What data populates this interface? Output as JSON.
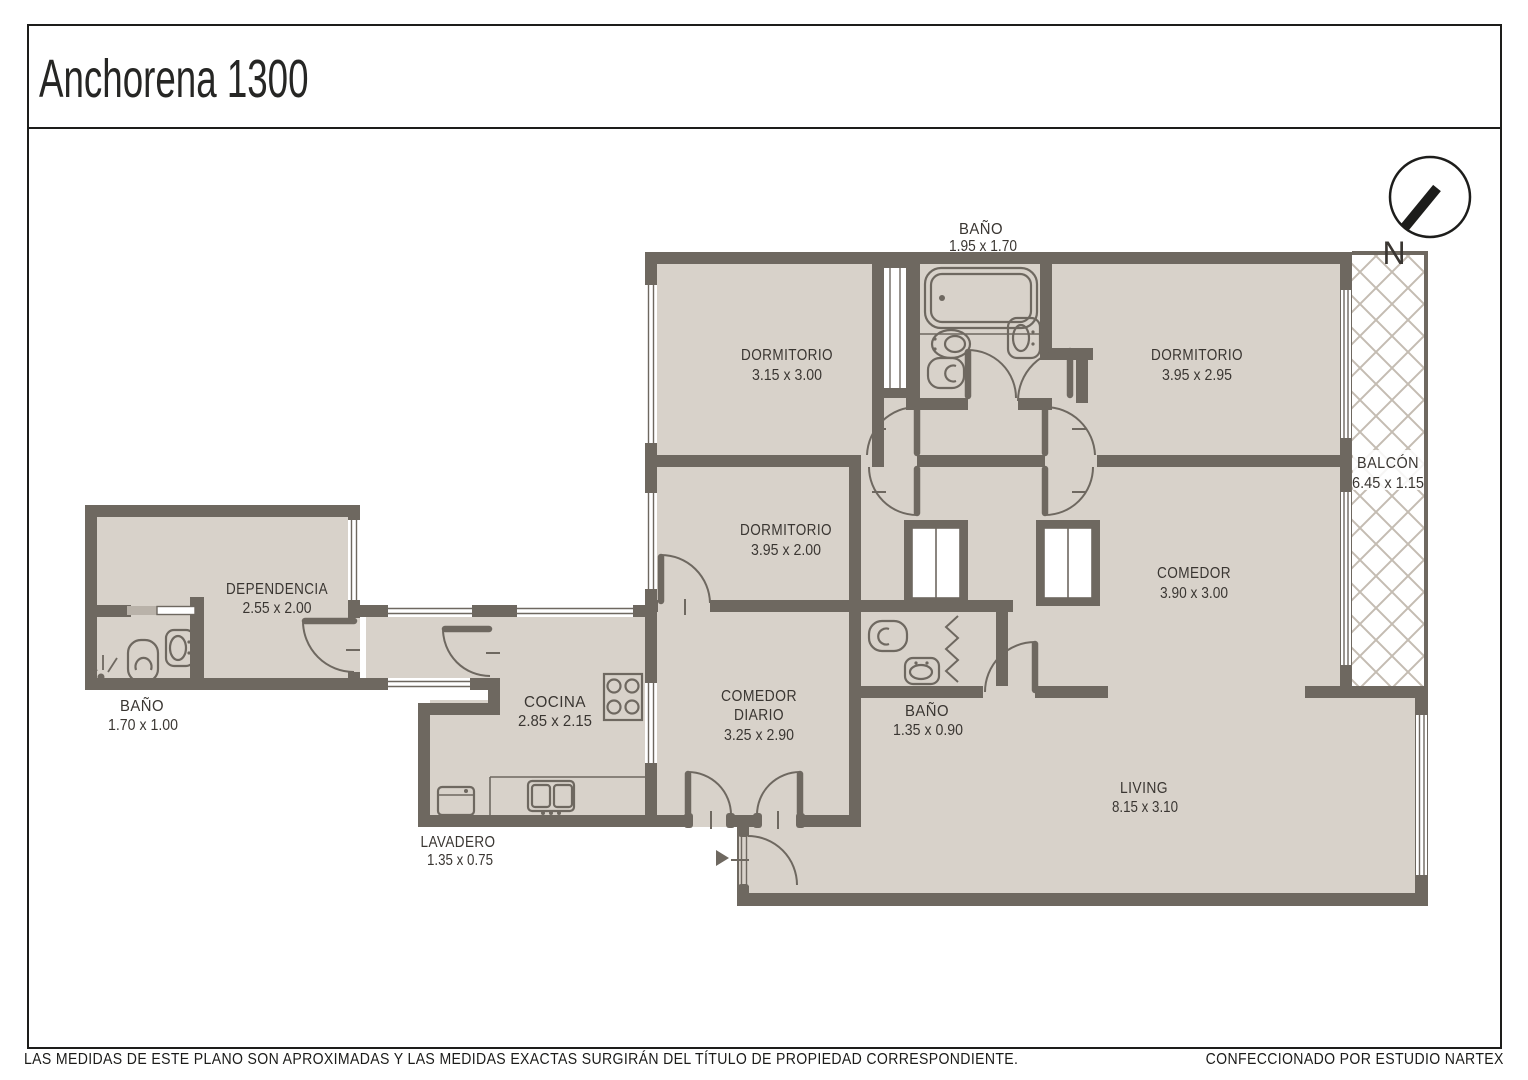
{
  "header": {
    "title": "Anchorena 1300"
  },
  "compass": {
    "label": "N"
  },
  "rooms": {
    "bano_principal": {
      "name": "BAÑO",
      "dims": "1.95 x 1.70"
    },
    "dormitorio_1": {
      "name": "DORMITORIO",
      "dims": "3.15 x 3.00"
    },
    "dormitorio_2": {
      "name": "DORMITORIO",
      "dims": "3.95 x 2.95"
    },
    "balcon": {
      "name": "BALCÓN",
      "dims": "6.45 x 1.15"
    },
    "dormitorio_3": {
      "name": "DORMITORIO",
      "dims": "3.95 x 2.00"
    },
    "comedor": {
      "name": "COMEDOR",
      "dims": "3.90 x 3.00"
    },
    "dependencia": {
      "name": "DEPENDENCIA",
      "dims": "2.55 x 2.00"
    },
    "bano_dependencia": {
      "name": "BAÑO",
      "dims": "1.70 x 1.00"
    },
    "cocina": {
      "name": "COCINA",
      "dims": "2.85 x 2.15"
    },
    "comedor_diario": {
      "line1": "COMEDOR",
      "line2": "DIARIO",
      "dims": "3.25 x 2.90"
    },
    "bano_servicio": {
      "name": "BAÑO",
      "dims": "1.35 x 0.90"
    },
    "living": {
      "name": "LIVING",
      "dims": "8.15 x 3.10"
    },
    "lavadero": {
      "name": "LAVADERO",
      "dims": "1.35 x 0.75"
    }
  },
  "footer": {
    "disclaimer": "LAS MEDIDAS  DE ESTE PLANO SON APROXIMADAS Y LAS MEDIDAS EXACTAS SURGIRÁN DEL TÍTULO DE PROPIEDAD CORRESPONDIENTE.",
    "credit": "CONFECCIONADO POR ESTUDIO NARTEX"
  },
  "colors": {
    "wall": "#6e6860",
    "floor": "#d8d2ca",
    "hatch": "#c4bcb2",
    "ink": "#3a3632"
  }
}
